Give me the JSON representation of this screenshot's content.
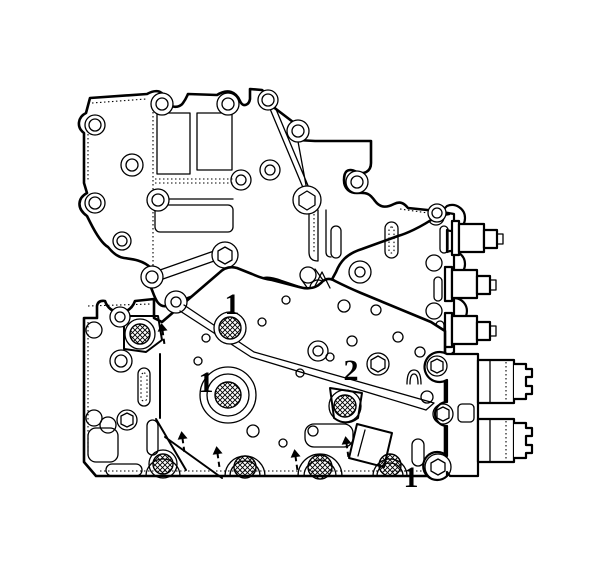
{
  "canvas": {
    "background": "#ffffff",
    "ink": "#000000",
    "width": 612,
    "height": 584
  },
  "diagram": {
    "kind": "line-art parts diagram",
    "callouts": [
      {
        "label": "1",
        "x": 232,
        "y": 305
      },
      {
        "label": "1",
        "x": 206,
        "y": 383
      },
      {
        "label": "2",
        "x": 351,
        "y": 371
      },
      {
        "label": "1",
        "x": 411,
        "y": 478
      }
    ],
    "pointer_arrows": [
      {
        "x": 163,
        "y": 323
      },
      {
        "x": 183,
        "y": 431
      },
      {
        "x": 218,
        "y": 446
      },
      {
        "x": 296,
        "y": 449
      },
      {
        "x": 347,
        "y": 436
      }
    ]
  }
}
